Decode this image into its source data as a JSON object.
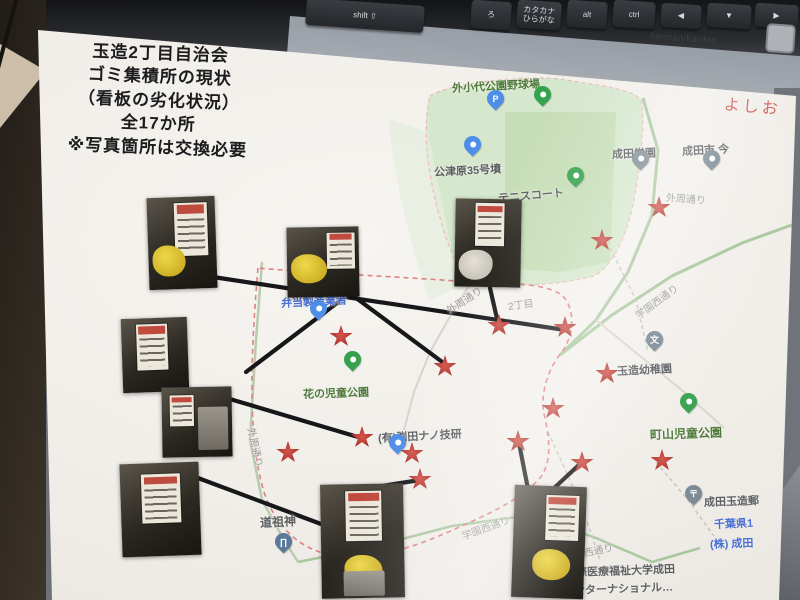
{
  "keyboard": {
    "brand_label": "harman/kardon",
    "keys": [
      {
        "label": "shift ⇧",
        "x": 306,
        "y": 2,
        "w": 118,
        "h": 27
      },
      {
        "label": "ろ",
        "x": 471,
        "y": 1,
        "w": 40,
        "h": 28
      },
      {
        "label": "カタカナ\nひらがな",
        "x": 517,
        "y": 1,
        "w": 44,
        "h": 28
      },
      {
        "label": "alt",
        "x": 567,
        "y": 1,
        "w": 40,
        "h": 27
      },
      {
        "label": "ctrl",
        "x": 613,
        "y": 1,
        "w": 42,
        "h": 27
      },
      {
        "label": "◀",
        "x": 661,
        "y": 4,
        "w": 40,
        "h": 24
      },
      {
        "label": "▼",
        "x": 707,
        "y": 4,
        "w": 44,
        "h": 24
      },
      {
        "label": "▶",
        "x": 755,
        "y": 4,
        "w": 43,
        "h": 24
      }
    ]
  },
  "paper": {
    "title_lines": [
      "玉造2丁目自治会",
      "ゴミ集積所の現状",
      "（看板の劣化状況）",
      "全17か所",
      "※写真箇所は交換必要"
    ],
    "survey_date": "令和3年6月10日調査",
    "handwritten_note": "よしお"
  },
  "map": {
    "labels": [
      {
        "text": "外小代公園野球場",
        "x": 452,
        "y": 80,
        "kind": "park",
        "size": 11,
        "rot": -3
      },
      {
        "text": "公津原35号墳",
        "x": 434,
        "y": 164,
        "kind": "place",
        "size": 11,
        "rot": -3
      },
      {
        "text": "テニスコート",
        "x": 498,
        "y": 190,
        "kind": "place",
        "size": 11,
        "rot": -5
      },
      {
        "text": "成田学園",
        "x": 612,
        "y": 146,
        "kind": "place",
        "size": 11,
        "rot": -2
      },
      {
        "text": "成田市 今",
        "x": 682,
        "y": 143,
        "kind": "place",
        "size": 11,
        "rot": -3
      },
      {
        "text": "外周通り",
        "x": 666,
        "y": 189,
        "kind": "road",
        "size": 10,
        "rot": 4
      },
      {
        "text": "外周通り",
        "x": 447,
        "y": 303,
        "kind": "road",
        "size": 10,
        "rot": -33
      },
      {
        "text": "2丁目",
        "x": 508,
        "y": 298,
        "kind": "road",
        "size": 10,
        "rot": -8
      },
      {
        "text": "学園西通り",
        "x": 636,
        "y": 308,
        "kind": "road",
        "size": 10,
        "rot": -36
      },
      {
        "text": "弁当製造業者",
        "x": 281,
        "y": 295,
        "kind": "biz",
        "size": 11,
        "rot": -3
      },
      {
        "text": "花の児童公園",
        "x": 303,
        "y": 386,
        "kind": "park",
        "size": 11,
        "rot": -2
      },
      {
        "text": "(有)渕田ナノ技研",
        "x": 378,
        "y": 430,
        "kind": "place",
        "size": 11,
        "rot": -3
      },
      {
        "text": "玉造幼稚園",
        "x": 617,
        "y": 363,
        "kind": "place",
        "size": 11,
        "rot": -3
      },
      {
        "text": "町山児童公園",
        "x": 650,
        "y": 426,
        "kind": "park",
        "size": 12,
        "rot": -2
      },
      {
        "text": "外周通り",
        "x": 252,
        "y": 420,
        "kind": "road",
        "size": 10,
        "rot": 78
      },
      {
        "text": "成田玉造郵",
        "x": 704,
        "y": 494,
        "kind": "place",
        "size": 11,
        "rot": -2
      },
      {
        "text": "千葉県1",
        "x": 714,
        "y": 516,
        "kind": "biz",
        "size": 11,
        "rot": -2
      },
      {
        "text": "(株) 成田",
        "x": 710,
        "y": 536,
        "kind": "biz",
        "size": 11,
        "rot": -2
      },
      {
        "text": "道祖神",
        "x": 260,
        "y": 514,
        "kind": "place",
        "size": 12,
        "rot": -3
      },
      {
        "text": "学園西通り",
        "x": 462,
        "y": 528,
        "kind": "road",
        "size": 10,
        "rot": -20
      },
      {
        "text": "学園西通り",
        "x": 564,
        "y": 549,
        "kind": "road",
        "size": 10,
        "rot": -12
      },
      {
        "text": "際医療福祉大学成田",
        "x": 576,
        "y": 564,
        "kind": "place",
        "size": 11,
        "rot": -2
      },
      {
        "text": "ンターナショナル…",
        "x": 574,
        "y": 582,
        "kind": "place",
        "size": 11,
        "rot": -2
      }
    ],
    "pins": [
      {
        "x": 597,
        "y": 64,
        "color": "gray",
        "glyph": "文"
      },
      {
        "x": 495,
        "y": 104,
        "color": "blue",
        "glyph": "P"
      },
      {
        "x": 542,
        "y": 100,
        "color": "green",
        "glyph": ""
      },
      {
        "x": 472,
        "y": 150,
        "color": "blue",
        "glyph": ""
      },
      {
        "x": 575,
        "y": 181,
        "color": "green",
        "glyph": ""
      },
      {
        "x": 640,
        "y": 164,
        "color": "gray",
        "glyph": ""
      },
      {
        "x": 711,
        "y": 164,
        "color": "gray",
        "glyph": ""
      },
      {
        "x": 318,
        "y": 314,
        "color": "blue",
        "glyph": ""
      },
      {
        "x": 352,
        "y": 365,
        "color": "green",
        "glyph": ""
      },
      {
        "x": 397,
        "y": 448,
        "color": "blue",
        "glyph": ""
      },
      {
        "x": 654,
        "y": 345,
        "color": "gray",
        "glyph": "文"
      },
      {
        "x": 688,
        "y": 407,
        "color": "green",
        "glyph": ""
      },
      {
        "x": 693,
        "y": 499,
        "color": "gray",
        "glyph": "〒"
      },
      {
        "x": 283,
        "y": 547,
        "color": "slate",
        "glyph": "∏"
      }
    ],
    "stars": [
      [
        659,
        207
      ],
      [
        602,
        240
      ],
      [
        499,
        325
      ],
      [
        565,
        327
      ],
      [
        341,
        336
      ],
      [
        445,
        366
      ],
      [
        607,
        373
      ],
      [
        553,
        408
      ],
      [
        362,
        437
      ],
      [
        412,
        453
      ],
      [
        420,
        479
      ],
      [
        288,
        452
      ],
      [
        518,
        441
      ],
      [
        582,
        462
      ],
      [
        662,
        460
      ]
    ],
    "connectors": [
      [
        213,
        277,
        565,
        330
      ],
      [
        352,
        295,
        445,
        364
      ],
      [
        345,
        297,
        246,
        372
      ],
      [
        196,
        389,
        358,
        437
      ],
      [
        198,
        478,
        321,
        524
      ],
      [
        420,
        480,
        363,
        489
      ],
      [
        528,
        489,
        519,
        443
      ],
      [
        552,
        490,
        581,
        463
      ],
      [
        490,
        288,
        498,
        323
      ]
    ],
    "photos": [
      {
        "x": 148,
        "y": 197,
        "w": 68,
        "h": 92,
        "rot": -2,
        "parts": {
          "sign": [
            40,
            6,
            48,
            58
          ],
          "yellow": [
            6,
            52,
            48,
            34
          ]
        }
      },
      {
        "x": 287,
        "y": 227,
        "w": 72,
        "h": 70,
        "rot": -1,
        "parts": {
          "sign": [
            56,
            8,
            38,
            52
          ],
          "yellow": [
            6,
            38,
            50,
            42
          ]
        }
      },
      {
        "x": 122,
        "y": 318,
        "w": 66,
        "h": 74,
        "rot": -2,
        "parts": {
          "sign": [
            22,
            8,
            48,
            62
          ]
        }
      },
      {
        "x": 162,
        "y": 387,
        "w": 70,
        "h": 70,
        "rot": -1,
        "parts": {
          "sign": [
            12,
            12,
            34,
            44
          ],
          "bin": [
            52,
            28,
            42,
            62
          ]
        }
      },
      {
        "x": 121,
        "y": 463,
        "w": 79,
        "h": 93,
        "rot": -2,
        "parts": {
          "sign": [
            26,
            12,
            50,
            52
          ]
        }
      },
      {
        "x": 321,
        "y": 484,
        "w": 83,
        "h": 114,
        "rot": -1,
        "parts": {
          "sign": [
            30,
            6,
            44,
            44
          ],
          "yellow": [
            28,
            62,
            46,
            26
          ],
          "bin": [
            26,
            76,
            50,
            22
          ]
        }
      },
      {
        "x": 455,
        "y": 199,
        "w": 66,
        "h": 88,
        "rot": 1,
        "parts": {
          "sign": [
            30,
            5,
            44,
            48
          ],
          "bags": [
            6,
            58,
            52,
            34
          ]
        }
      },
      {
        "x": 513,
        "y": 486,
        "w": 72,
        "h": 112,
        "rot": 2,
        "parts": {
          "sign": [
            44,
            8,
            46,
            40
          ],
          "yellow": [
            28,
            56,
            52,
            28
          ]
        }
      }
    ]
  },
  "colors": {
    "star": "#c13b33",
    "connector": "#17171a",
    "boundary": "#e08080",
    "park_fill": "#d5e7cc",
    "park_label": "#4d7a3a",
    "place_label": "#5d6063",
    "road_label": "#9b9b99",
    "business_label": "#4a6fd4",
    "pin_blue": "#4f8ee8",
    "pin_green": "#35a24e",
    "pin_gray": "#7b8a94",
    "handwriting": "#d4574e"
  }
}
